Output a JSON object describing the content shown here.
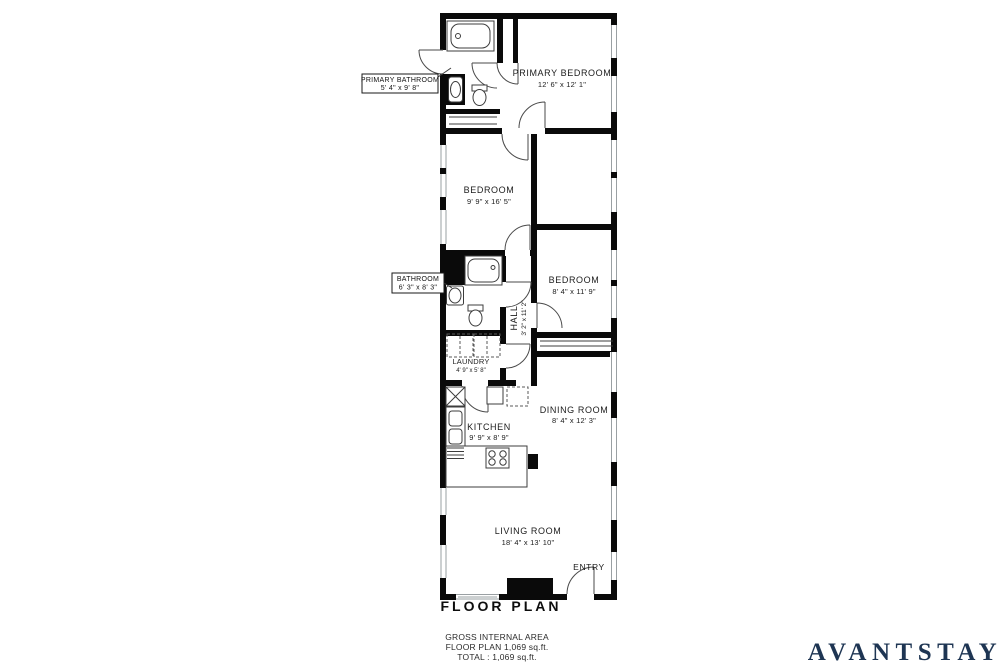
{
  "brand": {
    "name": "AVANTSTAY",
    "color": "#1e3553"
  },
  "title": {
    "label": "FLOOR PLAN"
  },
  "footer": {
    "line1": "GROSS INTERNAL AREA",
    "line2": "FLOOR PLAN 1,069 sq.ft.",
    "line3": "TOTAL :  1,069 sq.ft."
  },
  "rooms": {
    "primary_bedroom": {
      "name": "PRIMARY BEDROOM",
      "dims": "12' 6\" x 12' 1\""
    },
    "bedroom1": {
      "name": "BEDROOM",
      "dims": "9' 9\" x 16' 5\""
    },
    "bedroom2": {
      "name": "BEDROOM",
      "dims": "8' 4\" x 11' 9\""
    },
    "hall": {
      "name": "HALL",
      "dims": "3' 2\" x 11' 2\""
    },
    "laundry": {
      "name": "LAUNDRY",
      "dims": "4' 9\" x 5' 8\""
    },
    "dining": {
      "name": "DINING ROOM",
      "dims": "8' 4\" x 12' 3\""
    },
    "kitchen": {
      "name": "KITCHEN",
      "dims": "9' 9\" x 8' 9\""
    },
    "living": {
      "name": "LIVING ROOM",
      "dims": "18' 4\" x 13' 10\""
    },
    "entry": {
      "name": "ENTRY"
    }
  },
  "callouts": {
    "primary_bathroom": {
      "name": "PRIMARY BATHROOM",
      "dims": "5' 4\" x 9' 8\""
    },
    "bathroom": {
      "name": "BATHROOM",
      "dims": "6' 3\" x 8' 3\""
    }
  },
  "colors": {
    "wall": "#0a0a0a",
    "background": "#ffffff",
    "brand_navy": "#1e3553"
  }
}
